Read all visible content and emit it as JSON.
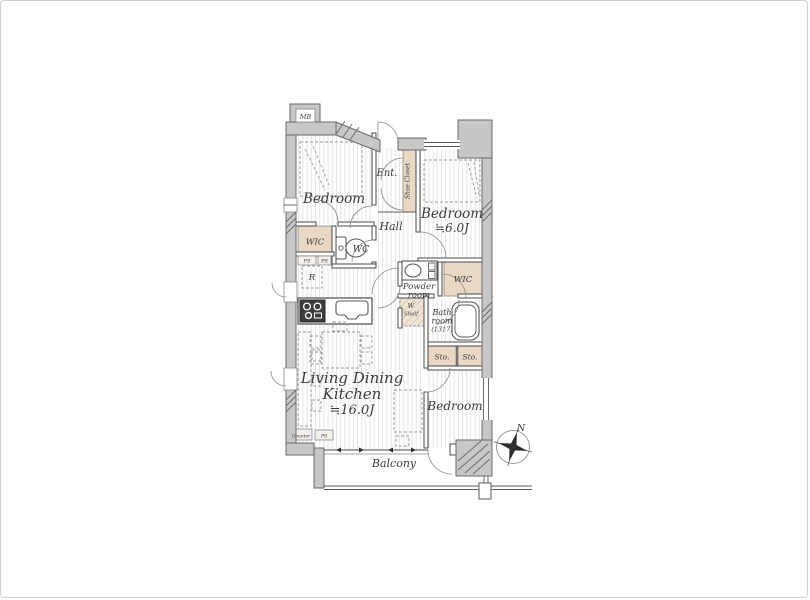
{
  "labels": {
    "mb": "MB",
    "bedroom1": "Bedroom",
    "ent": "Ent.",
    "shoe_closet": "Shoe Closet",
    "bedroom2_name": "Bedroom",
    "bedroom2_size": "≒6.0J",
    "hall": "Hall",
    "wic_left": "WIC",
    "wc": "WC",
    "refrigerator": "R",
    "ps_upper_left": "PS",
    "ps_upper_right": "PS",
    "powder_line1": "Powder",
    "powder_line2": "room",
    "wic_right": "WIC",
    "washer_line1": "W",
    "washer_line2": "Shelf",
    "bath_line1": "Bath",
    "bath_line2": "room",
    "bath_line3": "(1317)",
    "sto1": "Sto.",
    "sto2": "Sto.",
    "bedroom3": "Bedroom",
    "ldk_line1": "Living Dining",
    "ldk_line2": "Kitchen",
    "ldk_size": "≒16.0J",
    "counter": "Counter",
    "ps_bottom": "PS",
    "balcony": "Balcony",
    "compass_north": "N"
  },
  "colors": {
    "wall_fill": "#c7c7c7",
    "wall_stroke": "#6a6a6a",
    "closet_fill": "#e8d8c4",
    "floor_line": "#e5e5e5",
    "text": "#3c3c3c",
    "background": "#ffffff"
  }
}
